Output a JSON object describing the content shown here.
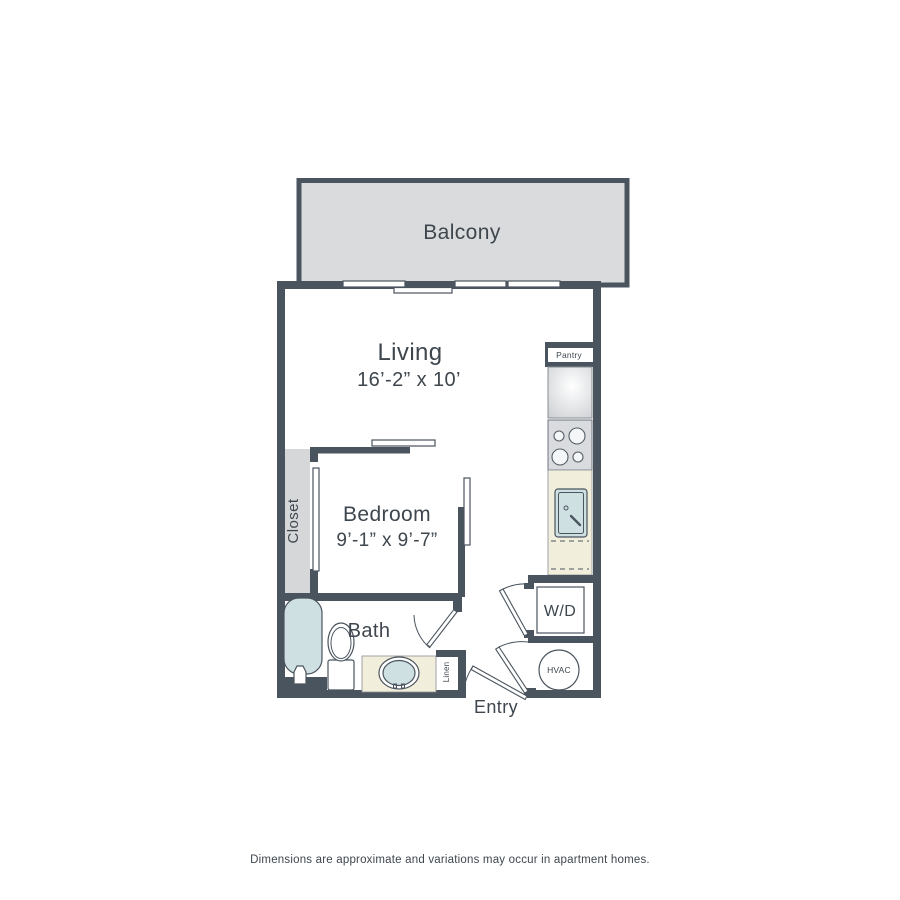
{
  "disclaimer": "Dimensions are approximate and variations may occur in apartment homes.",
  "rooms": {
    "balcony": {
      "label": "Balcony"
    },
    "living": {
      "label": "Living",
      "dims": "16’-2” x 10’"
    },
    "bedroom": {
      "label": "Bedroom",
      "dims": "9’-1” x 9’-7”"
    },
    "bath": {
      "label": "Bath"
    },
    "closet": {
      "label": "Closet"
    },
    "pantry": {
      "label": "Pantry"
    },
    "linen": {
      "label": "Linen"
    },
    "washer_dryer": {
      "label": "W/D"
    },
    "hvac": {
      "label": "HVAC"
    },
    "entry": {
      "label": "Entry"
    }
  },
  "colors": {
    "wall": "#4a545e",
    "ink": "#3e464e",
    "balcony_fill": "#d9dbdd",
    "closet_fill": "#d5d7d9",
    "counter_fill": "#f2eedc",
    "water_fill": "#cfe0e3",
    "appliance_fill": "#d9dbde"
  }
}
